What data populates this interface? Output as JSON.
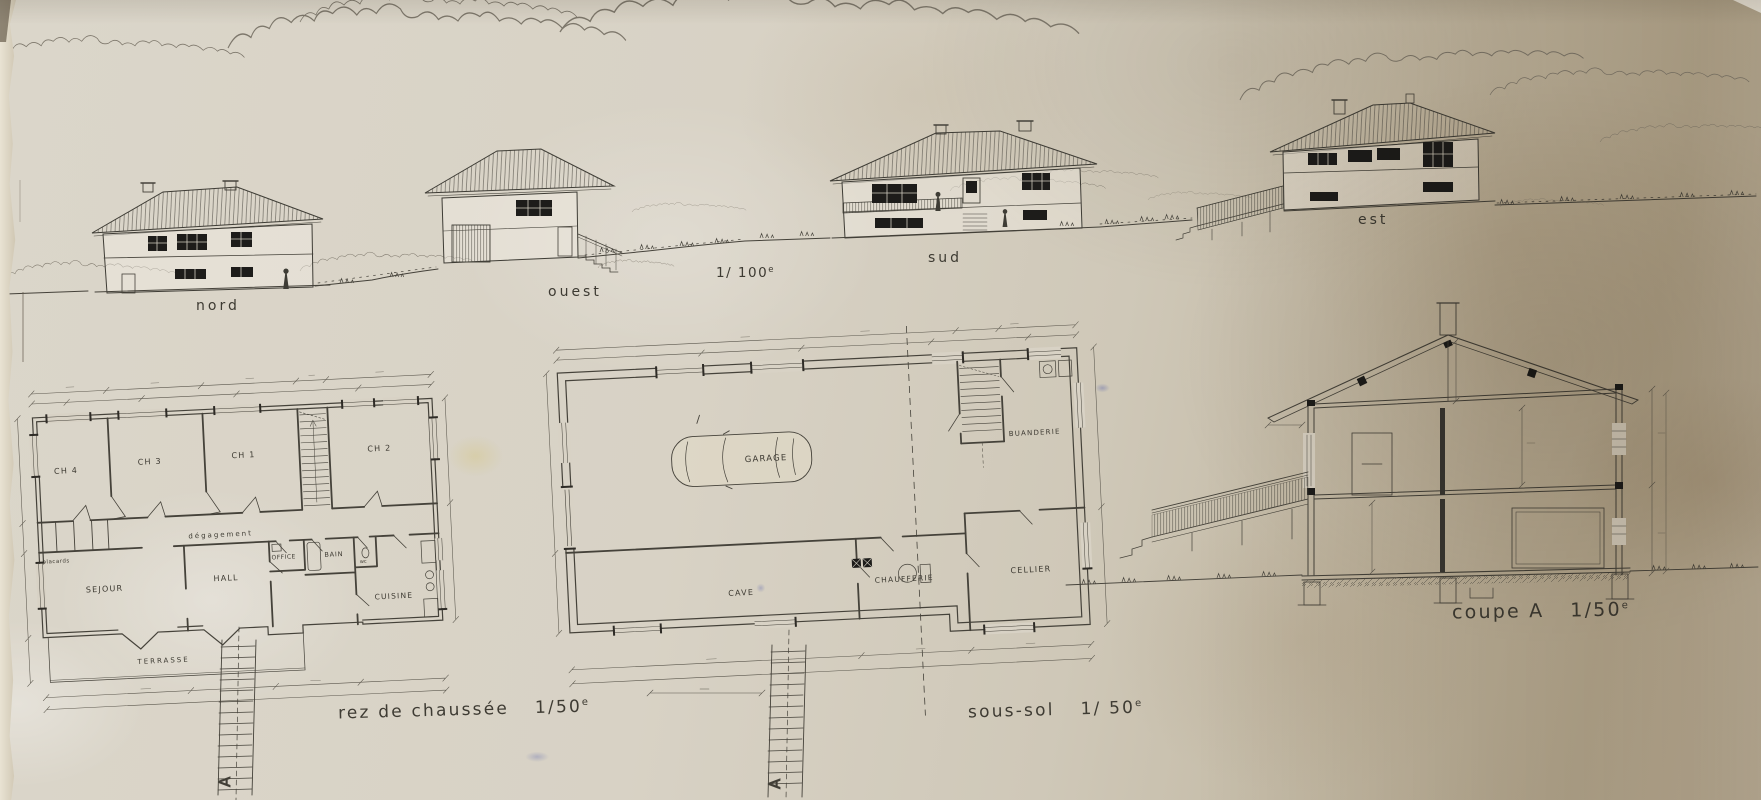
{
  "palette": {
    "paper": "#d7d1c4",
    "paper_dark": "#b8ac96",
    "ink": "#3e3b33",
    "window": "#1d1c1a"
  },
  "elevations": {
    "scale": "1/ 100",
    "scale_sup": "e",
    "nord": "nord",
    "ouest": "ouest",
    "sud": "sud",
    "est": "est"
  },
  "rez": {
    "caption": "rez de chaussée",
    "scale": "1/50",
    "scale_sup": "e",
    "rooms": {
      "ch4": "CH 4",
      "ch3": "CH 3",
      "ch1": "CH 1",
      "ch2": "CH 2",
      "degagement": "dégagement",
      "placards": "placards",
      "sejour": "SEJOUR",
      "hall": "HALL",
      "office": "OFFICE",
      "bain": "BAIN",
      "wc": "wc",
      "cuisine": "CUISINE",
      "terrasse": "TERRASSE"
    }
  },
  "soussol": {
    "caption": "sous-sol",
    "scale": "1/ 50",
    "scale_sup": "e",
    "rooms": {
      "garage": "GARAGE",
      "buanderie": "BUANDERIE",
      "cave": "CAVE",
      "chaufferie": "CHAUFFERIE",
      "cellier": "CELLIER"
    }
  },
  "coupe": {
    "caption": "coupe A",
    "scale": "1/50",
    "scale_sup": "e"
  },
  "section_marker": "A"
}
